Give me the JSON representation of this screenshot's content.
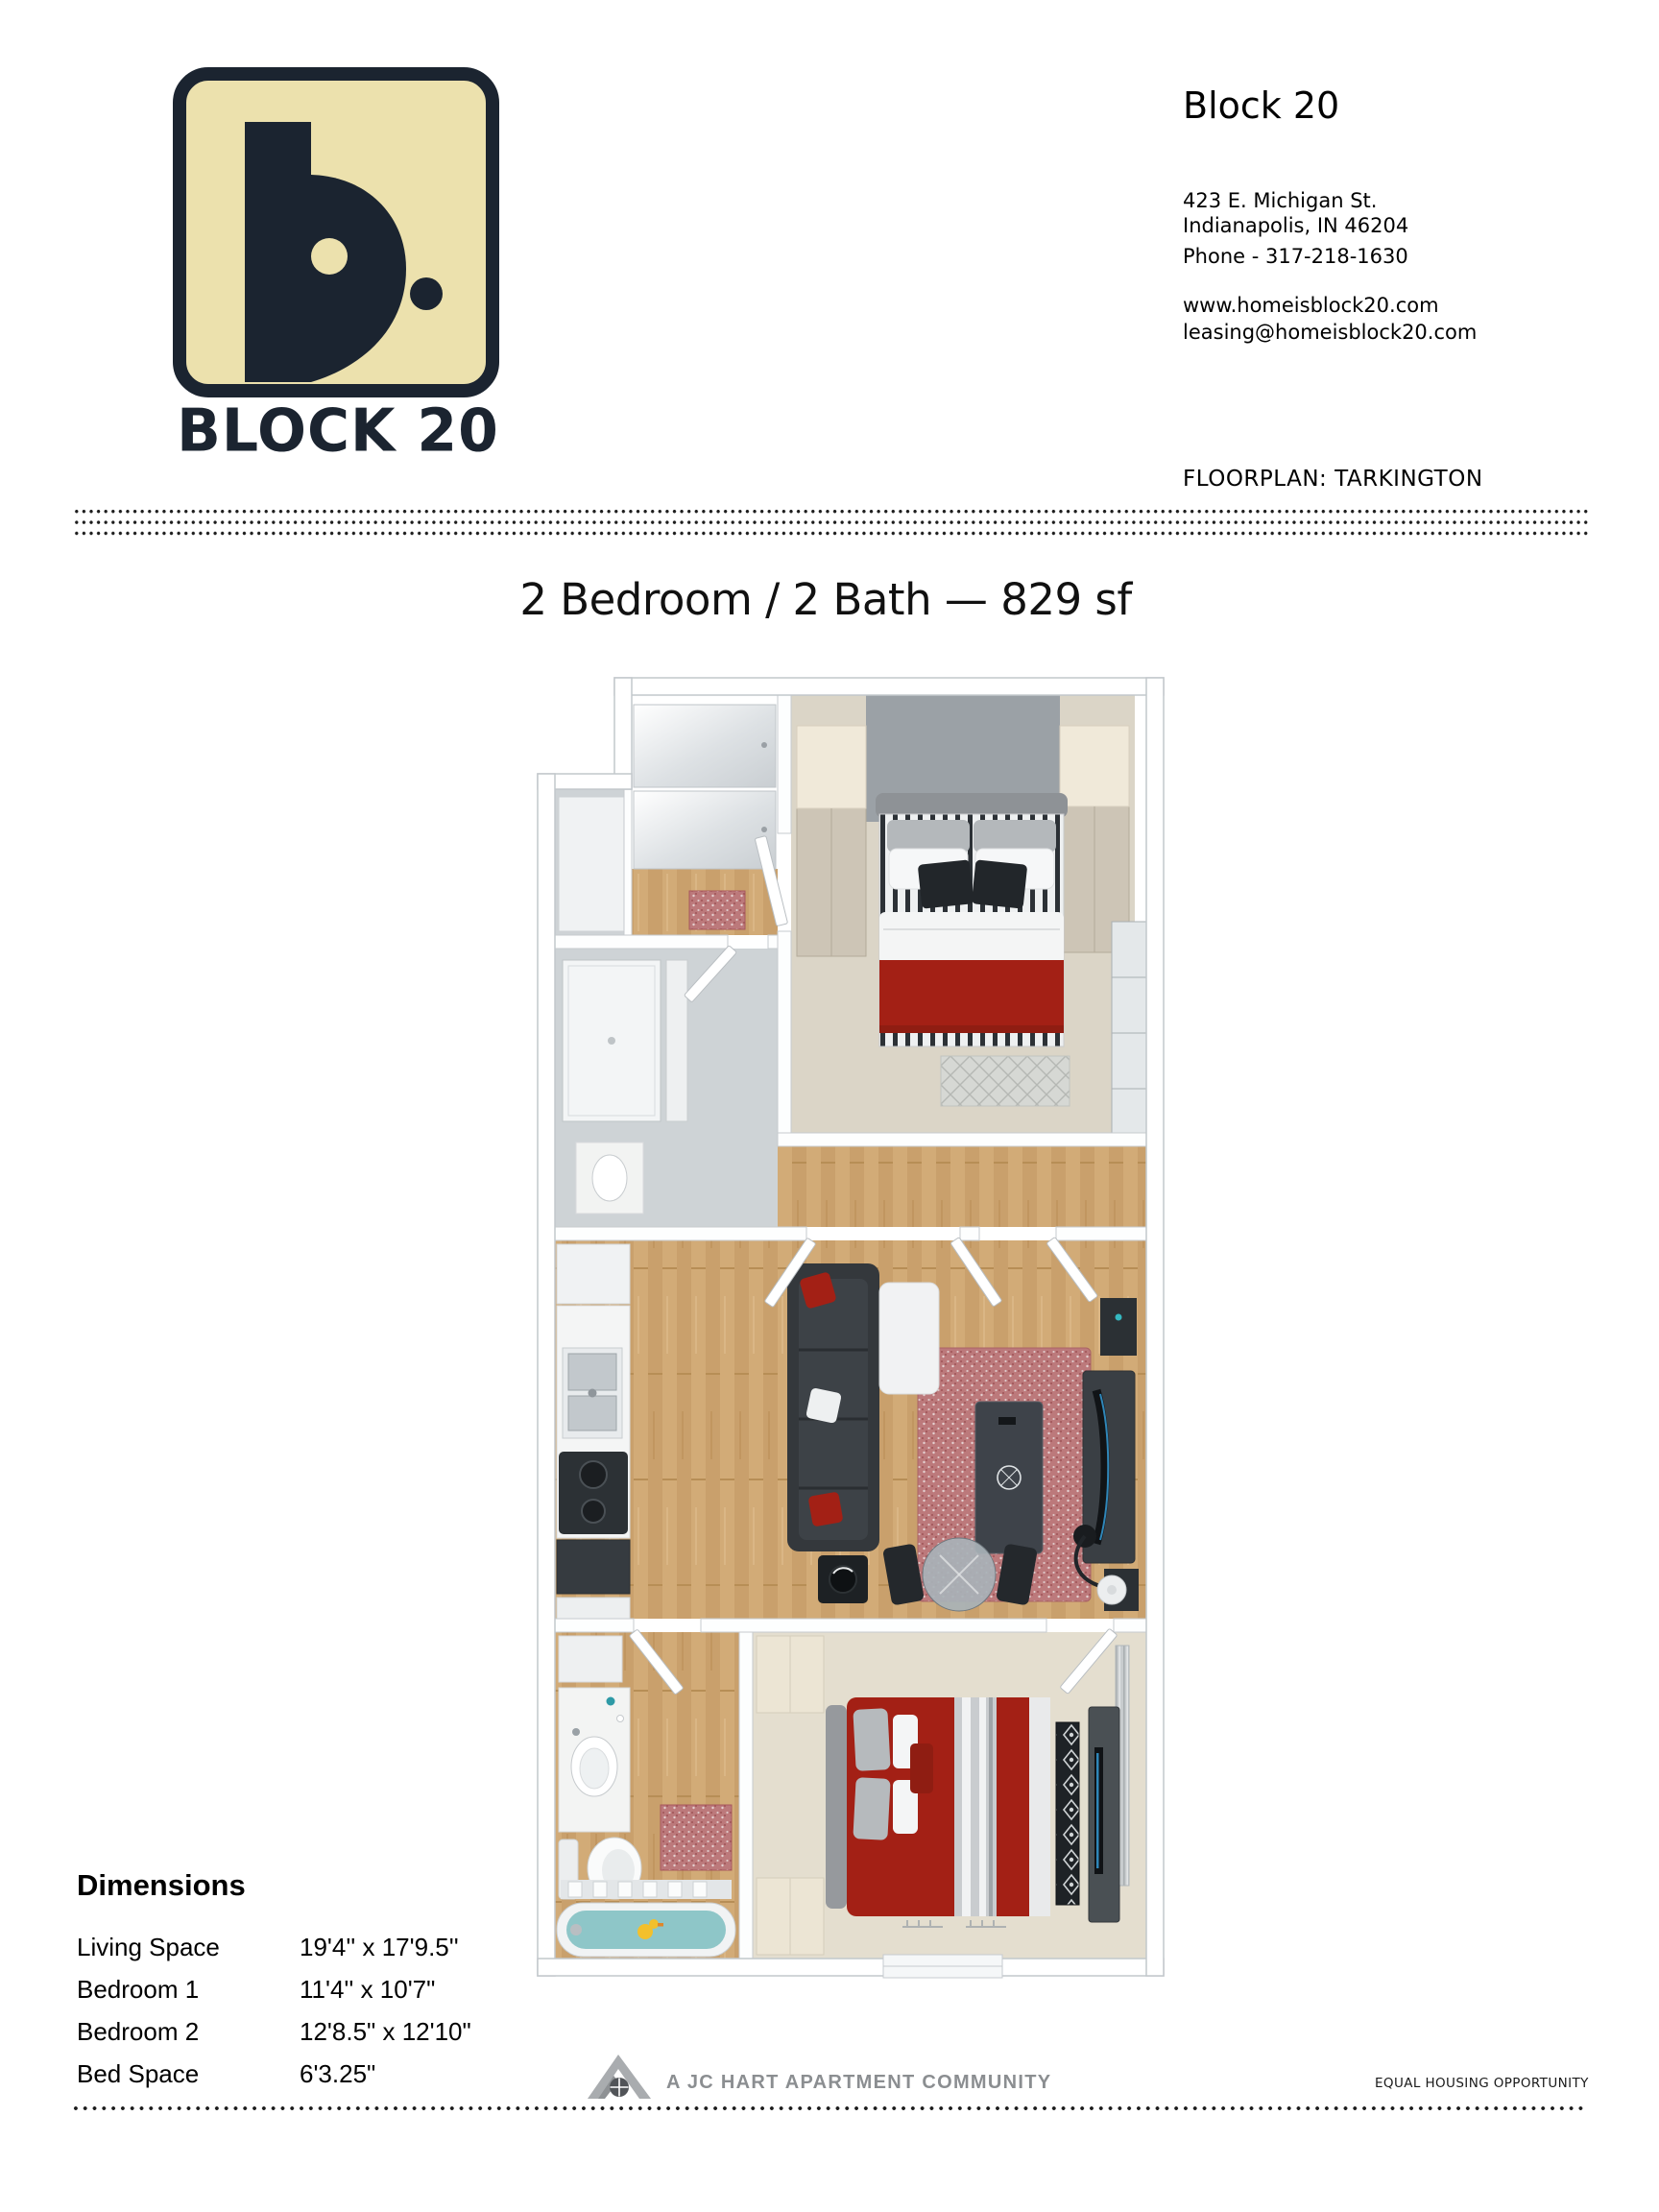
{
  "brand": {
    "name": "BLOCK 20",
    "glyph": "b."
  },
  "header": {
    "title": "Block 20",
    "address_line1": "423 E. Michigan St.",
    "address_line2": "Indianapolis, IN 46204",
    "phone": "Phone - 317-218-1630",
    "website": "www.homeisblock20.com",
    "email": "leasing@homeisblock20.com",
    "floorplan_label": "FLOORPLAN: TARKINGTON"
  },
  "plan": {
    "heading": "2 Bedroom / 2 Bath — 829 sf"
  },
  "dimensions": {
    "title": "Dimensions",
    "rows": [
      {
        "label": "Living Space",
        "value": "19'4'' x 17'9.5''"
      },
      {
        "label": "Bedroom 1",
        "value": "11'4'' x 10'7\""
      },
      {
        "label": "Bedroom 2",
        "value": "12'8.5\" x 12'10\""
      },
      {
        "label": "Bed Space",
        "value": "6'3.25\""
      }
    ]
  },
  "footer": {
    "community": "A JC HART APARTMENT COMMUNITY",
    "equal_housing": "EQUAL HOUSING OPPORTUNITY"
  },
  "colors": {
    "navy": "#1b2430",
    "cream": "#ece1ad",
    "accent-red": "#a32015",
    "footer-gray": "#8b8e91"
  }
}
